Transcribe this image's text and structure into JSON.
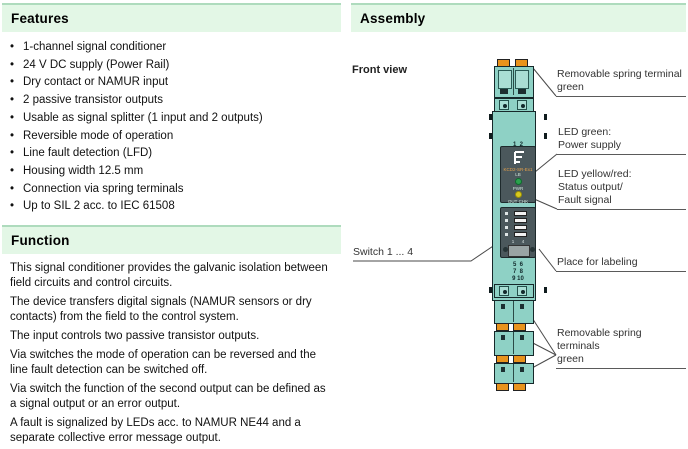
{
  "features": {
    "title": "Features",
    "items": [
      "1-channel signal conditioner",
      "24 V DC supply (Power Rail)",
      "Dry contact or NAMUR input",
      "2 passive transistor outputs",
      "Usable as signal splitter (1 input and 2 outputs)",
      "Reversible mode of operation",
      "Line fault detection (LFD)",
      "Housing width 12.5 mm",
      "Connection via spring terminals",
      "Up to SIL 2 acc. to IEC 61508"
    ]
  },
  "function": {
    "title": "Function",
    "paragraphs": [
      "This signal conditioner provides the galvanic isolation between field circuits and control circuits.",
      "The device transfers digital signals (NAMUR sensors or dry contacts) from the field to the control system.",
      "The input controls two passive transistor outputs.",
      "Via switches the mode of operation can be reversed and the line fault detection can be switched off.",
      "Via switch the function of the second output can be defined as a signal output or an error output.",
      "A fault is signalized by LEDs acc. to NAMUR NE44 and a separate collective error message output."
    ]
  },
  "assembly": {
    "title": "Assembly",
    "front_view": "Front view",
    "callouts": {
      "terminal_top": "Removable spring terminal\ngreen",
      "led_green": "LED green:\nPower supply",
      "led_yellow": "LED yellow/red:\nStatus output/\nFault signal",
      "switches": "Switch 1 ... 4",
      "labeling": "Place for labeling",
      "terminals_bottom": "Removable spring terminals\ngreen"
    },
    "device": {
      "terminals_top_numbers": "1  2\n3  4",
      "label_model_line1": "KCD2-SR-Ex1",
      "label_model_line2": "LB",
      "led_green_text": "PWR",
      "led_yellow_text": "OUT CHK",
      "switch_numbers": "1      4",
      "terminals_mid_numbers": "5  6\n7  8\n9 10"
    }
  },
  "colors": {
    "header_bg": "#e3f7e6",
    "header_top_edge": "#aedbbd",
    "device_teal": "#8ed1c5",
    "device_teal_light": "#a9ded4",
    "device_outline": "#16282a",
    "clamp_orange": "#e9931c",
    "panel_dark": "#4b585c",
    "led_green": "#2ba24e",
    "led_yellow": "#d8ca1e",
    "leader_line": "#4a4a4a"
  }
}
